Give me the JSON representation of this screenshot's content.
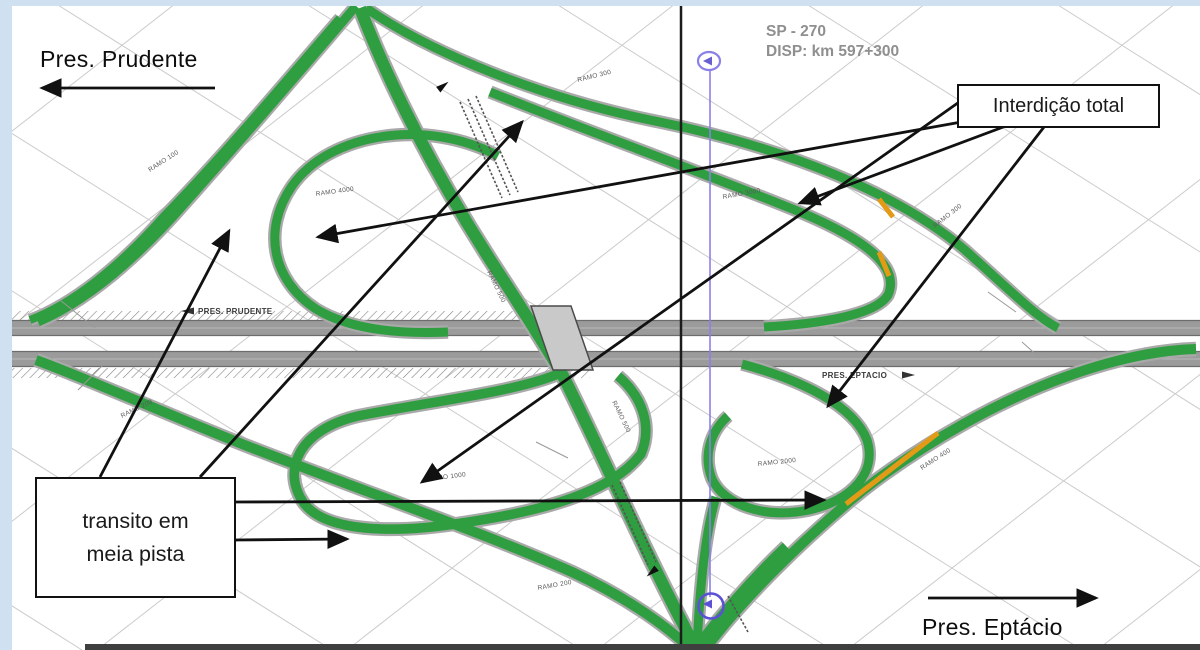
{
  "titles": {
    "dest_left": "Pres. Prudente",
    "route": "SP - 270",
    "disp": "DISP: km 597+300",
    "dest_right": "Pres. Eptácio"
  },
  "callouts": {
    "total_closure": "Interdição total",
    "half_lane_line1": "transito em",
    "half_lane_line2": "meia pista"
  },
  "colors": {
    "ramp_green": "#2f9e41",
    "ramp_casing": "#a9a9a9",
    "work_orange": "#e39b17",
    "highway_gray": "#9b9b9b",
    "highway_edge": "#6d6d6d",
    "grid_gray": "#cbcbcb",
    "survey_purple": "#8a80e8",
    "survey_purple_dark": "#5b51d6",
    "annotation_black": "#111111",
    "frame_blue": "#cfe1f1",
    "bottom_bar": "#3f3f3f"
  },
  "map_labels": [
    {
      "text": "RAMO 100",
      "x": 150,
      "y": 172,
      "rot": -33
    },
    {
      "text": "RAMO 300",
      "x": 578,
      "y": 82,
      "rot": -14
    },
    {
      "text": "RAMO 4000",
      "x": 316,
      "y": 196,
      "rot": -8
    },
    {
      "text": "RAMO 500",
      "x": 487,
      "y": 272,
      "rot": 64
    },
    {
      "text": "RAMO 500",
      "x": 612,
      "y": 402,
      "rot": 64
    },
    {
      "text": "RAMO 1000",
      "x": 428,
      "y": 481,
      "rot": -7
    },
    {
      "text": "RAMO 200",
      "x": 122,
      "y": 418,
      "rot": -26
    },
    {
      "text": "RAMO 200",
      "x": 538,
      "y": 590,
      "rot": -10
    },
    {
      "text": "RAMO 3000",
      "x": 723,
      "y": 199,
      "rot": -10
    },
    {
      "text": "RAMO 300",
      "x": 935,
      "y": 228,
      "rot": -38
    },
    {
      "text": "RAMO 2000",
      "x": 758,
      "y": 466,
      "rot": -6
    },
    {
      "text": "RAMO 400",
      "x": 922,
      "y": 470,
      "rot": -33
    },
    {
      "text": "PRES. PRUDENTE",
      "x": 198,
      "y": 314,
      "rot": 0,
      "size": 8,
      "bold": true
    },
    {
      "text": "PRES. EPTACIO",
      "x": 822,
      "y": 378,
      "rot": 0,
      "size": 8,
      "bold": true
    }
  ],
  "arrows": [
    {
      "x1": 215,
      "y1": 88,
      "x2": 42,
      "y2": 88
    },
    {
      "x1": 928,
      "y1": 598,
      "x2": 1096,
      "y2": 598
    },
    {
      "x1": 1006,
      "y1": 126,
      "x2": 800,
      "y2": 203
    },
    {
      "x1": 995,
      "y1": 116,
      "x2": 318,
      "y2": 237
    },
    {
      "x1": 1044,
      "y1": 127,
      "x2": 828,
      "y2": 406
    },
    {
      "x1": 962,
      "y1": 100,
      "x2": 422,
      "y2": 482
    },
    {
      "x1": 100,
      "y1": 477,
      "x2": 229,
      "y2": 231
    },
    {
      "x1": 200,
      "y1": 477,
      "x2": 522,
      "y2": 122
    },
    {
      "x1": 233,
      "y1": 502,
      "x2": 824,
      "y2": 500
    },
    {
      "x1": 233,
      "y1": 540,
      "x2": 347,
      "y2": 539
    }
  ]
}
